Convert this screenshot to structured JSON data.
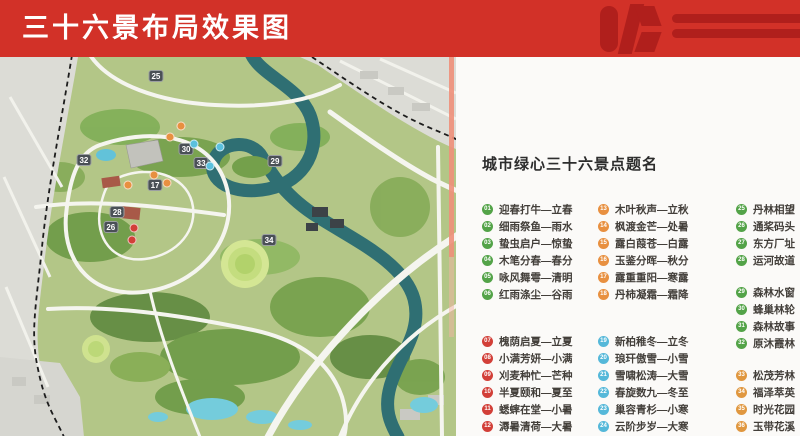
{
  "header": {
    "title": "三十六景布局效果图"
  },
  "legend": {
    "title": "城市绿心三十六景点题名",
    "columns": [
      {
        "groups": [
          {
            "color": "#53a348",
            "items": [
              {
                "num": "01",
                "label": "迎春打牛—立春"
              },
              {
                "num": "02",
                "label": "细雨祭鱼—雨水"
              },
              {
                "num": "03",
                "label": "蛰虫启户—惊蛰"
              },
              {
                "num": "04",
                "label": "木笔分春—春分"
              },
              {
                "num": "05",
                "label": "咏风舞雩—清明"
              },
              {
                "num": "06",
                "label": "红雨涤尘—谷雨"
              }
            ]
          },
          {
            "color": "#d23f38",
            "items": [
              {
                "num": "07",
                "label": "槐荫启夏—立夏"
              },
              {
                "num": "08",
                "label": "小满芳妍—小满"
              },
              {
                "num": "09",
                "label": "刈麦种忙—芒种"
              },
              {
                "num": "10",
                "label": "半夏颐和—夏至"
              },
              {
                "num": "11",
                "label": "蟋蟀在堂—小暑"
              },
              {
                "num": "12",
                "label": "溽暑清荷—大暑"
              }
            ]
          }
        ]
      },
      {
        "groups": [
          {
            "color": "#e89040",
            "items": [
              {
                "num": "13",
                "label": "木叶秋声—立秋"
              },
              {
                "num": "14",
                "label": "枫渡金芒—处暑"
              },
              {
                "num": "15",
                "label": "露白葭苍—白露"
              },
              {
                "num": "16",
                "label": "玉鉴分晖—秋分"
              },
              {
                "num": "17",
                "label": "露重重阳—寒露"
              },
              {
                "num": "18",
                "label": "丹柿凝霜—霜降"
              }
            ]
          },
          {
            "color": "#55b8d9",
            "items": [
              {
                "num": "19",
                "label": "新柏稚冬—立冬"
              },
              {
                "num": "20",
                "label": "琅玕傲雪—小雪"
              },
              {
                "num": "21",
                "label": "雪啸松涛—大雪"
              },
              {
                "num": "22",
                "label": "春旋数九—冬至"
              },
              {
                "num": "23",
                "label": "巢容青杉—小寒"
              },
              {
                "num": "24",
                "label": "云阶步岁—大寒"
              }
            ]
          }
        ]
      },
      {
        "groups": [
          {
            "color": "#53a348",
            "items": [
              {
                "num": "25",
                "label": "丹林相望"
              },
              {
                "num": "26",
                "label": "通桨码头"
              },
              {
                "num": "27",
                "label": "东方厂址"
              },
              {
                "num": "28",
                "label": "运河故道"
              }
            ]
          },
          {
            "color": "#53a348",
            "items": [
              {
                "num": "29",
                "label": "森林水窗"
              },
              {
                "num": "30",
                "label": "蜂巢林轮"
              },
              {
                "num": "31",
                "label": "森林故事"
              },
              {
                "num": "32",
                "label": "原沐霞林"
              }
            ]
          },
          {
            "color": "#e0973f",
            "items": [
              {
                "num": "33",
                "label": "松茂芳林"
              },
              {
                "num": "34",
                "label": "福泽萃英"
              },
              {
                "num": "35",
                "label": "时光花园"
              },
              {
                "num": "36",
                "label": "玉带花溪"
              }
            ]
          }
        ]
      }
    ]
  },
  "map": {
    "markers": [
      {
        "num": "25",
        "kind": "square",
        "x": 34.2,
        "y": 5.0
      },
      {
        "num": "30",
        "kind": "square",
        "x": 40.8,
        "y": 24.3
      },
      {
        "num": "29",
        "kind": "square",
        "x": 60.3,
        "y": 27.4
      },
      {
        "num": "32",
        "kind": "square",
        "x": 18.4,
        "y": 27.2
      },
      {
        "num": "33",
        "kind": "square",
        "x": 44.1,
        "y": 28.0
      },
      {
        "num": "17",
        "kind": "square",
        "x": 34.0,
        "y": 33.8
      },
      {
        "num": "28",
        "kind": "square",
        "x": 25.7,
        "y": 40.9
      },
      {
        "num": "26",
        "kind": "square",
        "x": 24.3,
        "y": 44.9
      },
      {
        "num": "34",
        "kind": "square",
        "x": 59.0,
        "y": 48.3
      },
      {
        "num": "",
        "kind": "dot",
        "color": "#e89040",
        "x": 39.7,
        "y": 18.2
      },
      {
        "num": "",
        "kind": "dot",
        "color": "#e89040",
        "x": 37.3,
        "y": 21.1
      },
      {
        "num": "",
        "kind": "dot",
        "color": "#e89040",
        "x": 33.8,
        "y": 31.1
      },
      {
        "num": "",
        "kind": "dot",
        "color": "#e89040",
        "x": 36.6,
        "y": 33.2
      },
      {
        "num": "",
        "kind": "dot",
        "color": "#e89040",
        "x": 28.1,
        "y": 33.8
      },
      {
        "num": "",
        "kind": "dot",
        "color": "#5ac0dd",
        "x": 42.5,
        "y": 23.0
      },
      {
        "num": "",
        "kind": "dot",
        "color": "#5ac0dd",
        "x": 46.1,
        "y": 28.8
      },
      {
        "num": "",
        "kind": "dot",
        "color": "#5ac0dd",
        "x": 48.2,
        "y": 23.7
      },
      {
        "num": "",
        "kind": "dot",
        "color": "#d23f38",
        "x": 29.4,
        "y": 45.1
      },
      {
        "num": "",
        "kind": "dot",
        "color": "#d23f38",
        "x": 28.9,
        "y": 48.3
      }
    ]
  }
}
